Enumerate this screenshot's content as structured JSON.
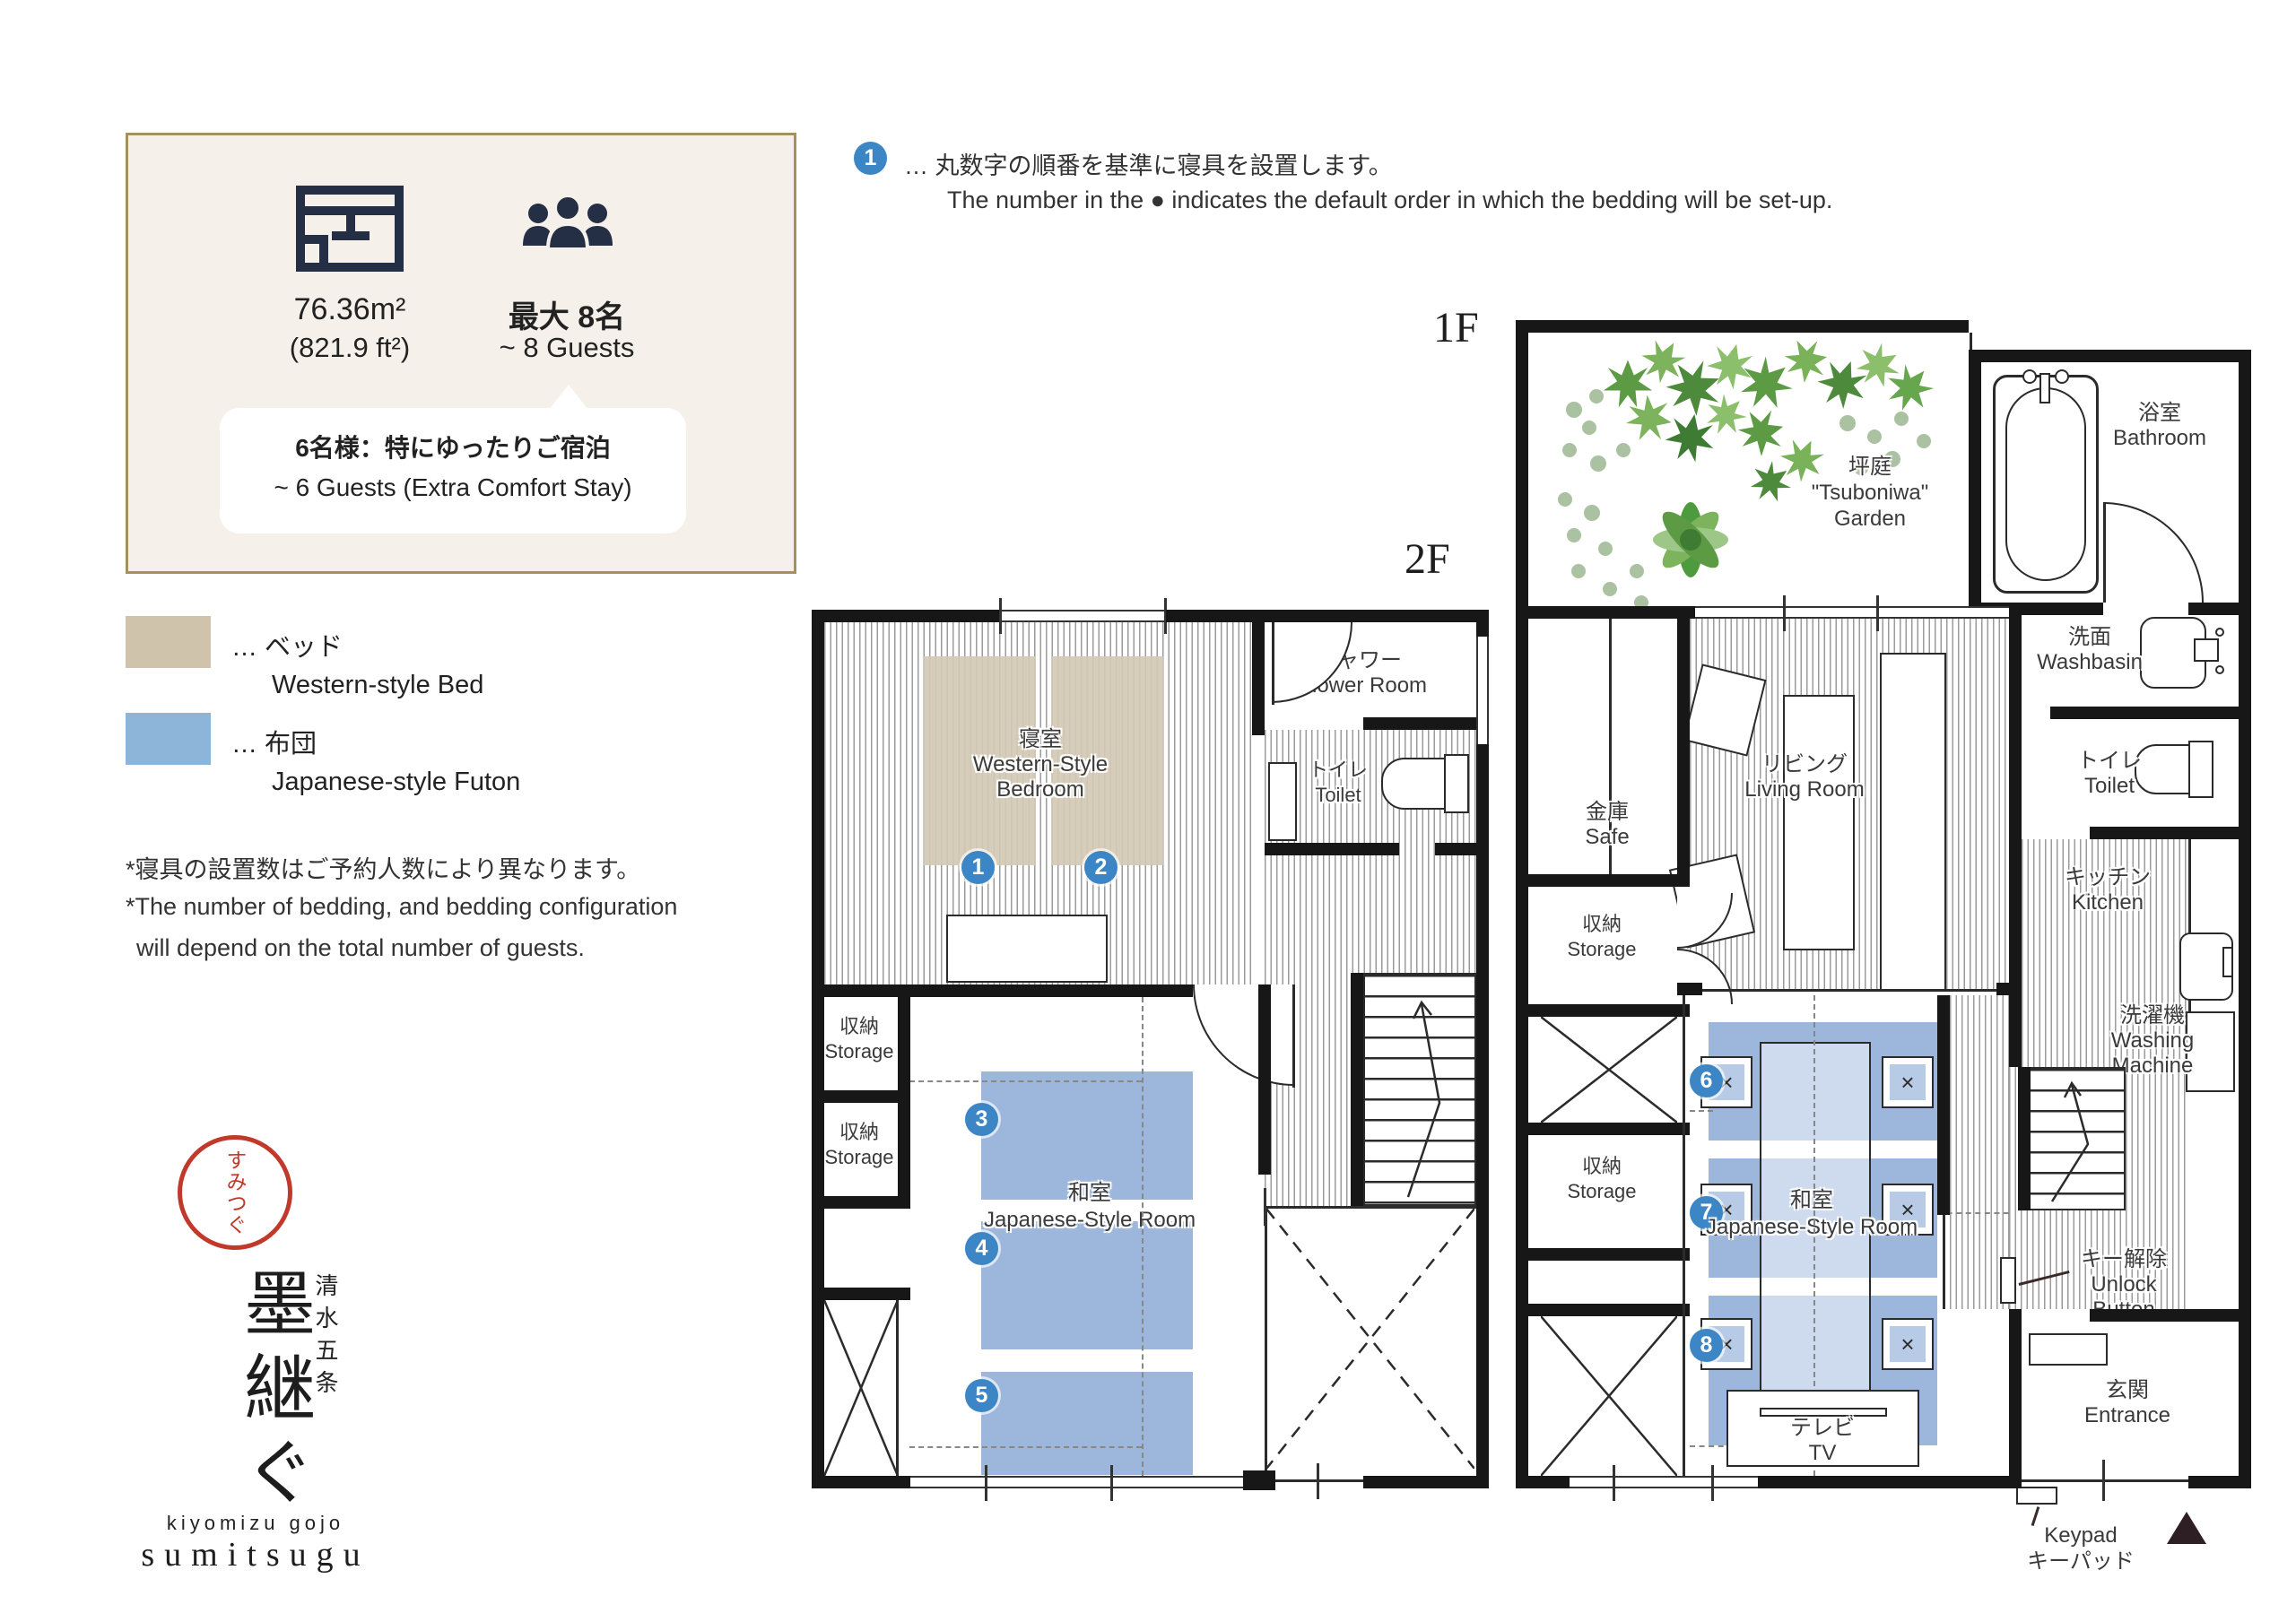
{
  "info": {
    "area1": "76.36m²",
    "area2": "(821.9 ft²)",
    "guests1": "最大 8名",
    "guests2": "~ 8 Guests",
    "callout1": "6名様：特にゆったりご宿泊",
    "callout2": "~ 6 Guests (Extra Comfort Stay)"
  },
  "legend": {
    "bed_jp": "… ベッド",
    "bed_en": "Western-style Bed",
    "futon_jp": "… 布団",
    "futon_en": "Japanese-style Futon",
    "bed_color": "#cfc4ab",
    "futon_color": "#8db4d9"
  },
  "notes": {
    "jp": "*寝具の設置数はご予約人数により異なります。",
    "en1": "*The number of bedding, and bedding configuration",
    "en2": "will depend on the total number of guests."
  },
  "setup_note": {
    "num": "1",
    "jp": "… 丸数字の順番を基準に寝具を設置します。",
    "en": "The number in the ● indicates the default order in which the bedding will be set-up."
  },
  "logo": {
    "seal": "すみつぐ",
    "sub": "清水五条",
    "main": "墨継ぐ",
    "latin1": "kiyomizu gojo",
    "latin2": "sumitsugu"
  },
  "f2": {
    "label": "2F",
    "bedroom": {
      "jp": "寝室",
      "en1": "Western-Style",
      "en2": "Bedroom"
    },
    "shower": {
      "jp": "シャワー",
      "en": "Shower Room"
    },
    "toilet": {
      "jp": "トイレ",
      "en": "Toilet"
    },
    "storage": {
      "jp": "収納",
      "en": "Storage"
    },
    "washitsu": {
      "jp": "和室",
      "en": "Japanese-Style Room"
    },
    "markers": [
      "1",
      "2",
      "3",
      "4",
      "5"
    ]
  },
  "f1": {
    "label": "1F",
    "garden": {
      "jp": "坪庭",
      "en1": "\"Tsuboniwa\"",
      "en2": "Garden"
    },
    "bath": {
      "jp": "浴室",
      "en": "Bathroom"
    },
    "wash": {
      "jp": "洗面",
      "en": "Washbasin"
    },
    "toilet": {
      "jp": "トイレ",
      "en": "Toilet"
    },
    "living": {
      "jp": "リビング",
      "en": "Living Room"
    },
    "safe": {
      "jp": "金庫",
      "en": "Safe"
    },
    "storage": {
      "jp": "収納",
      "en": "Storage"
    },
    "kitchen": {
      "jp": "キッチン",
      "en": "Kitchen"
    },
    "laundry": {
      "jp": "洗濯機",
      "en1": "Washing",
      "en2": "Machine"
    },
    "washitsu": {
      "jp": "和室",
      "en": "Japanese-Style Room"
    },
    "tv": {
      "jp": "テレビ",
      "en": "TV"
    },
    "entrance": {
      "jp": "玄関",
      "en": "Entrance"
    },
    "unlock": {
      "jp": "キー解除",
      "en1": "Unlock",
      "en2": "Button"
    },
    "keypad": {
      "en": "Keypad",
      "jp": "キーパッド"
    },
    "chair": "×",
    "markers": [
      "6",
      "7",
      "8"
    ]
  }
}
